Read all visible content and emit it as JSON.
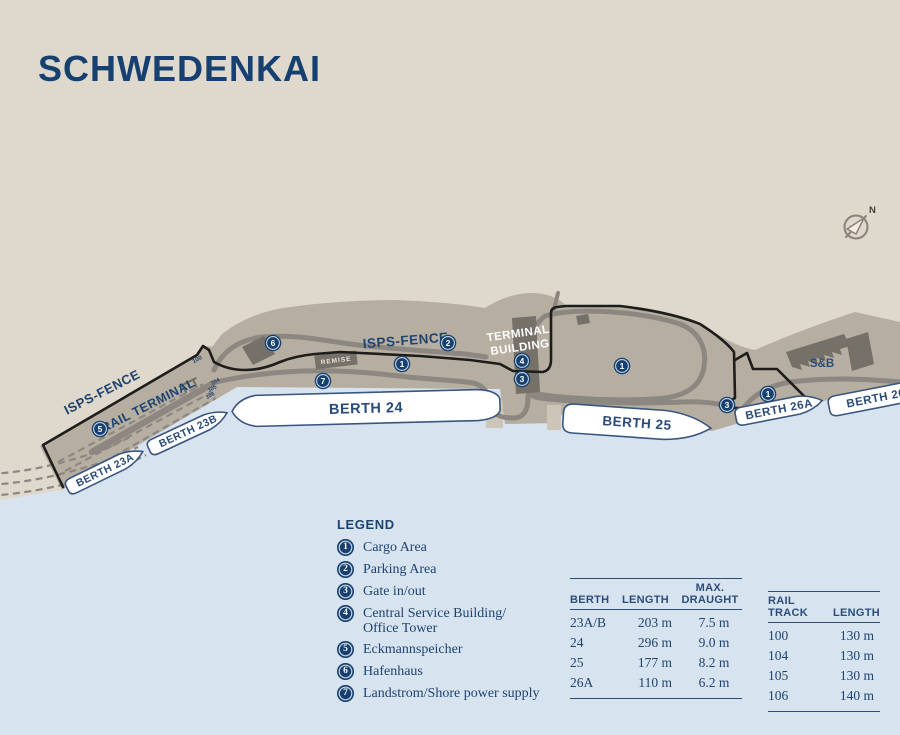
{
  "title": "SCHWEDENKAI",
  "compass": {
    "north_label": "N"
  },
  "colors": {
    "navy": "#16406f",
    "beige": "#dfd8cc",
    "water": "#d7e3ef",
    "pier": "#b7aea2",
    "road": "#8d8781",
    "building": "#757068",
    "fence": "#1d1d1b",
    "ship_fill": "#ffffff"
  },
  "map": {
    "labels": {
      "isps_fence_left": "ISPS-FENCE",
      "isps_fence_center": "ISPS-FENCE",
      "rail_terminal": "RAIL TERMINAL",
      "terminal_building_line1": "TERMINAL",
      "terminal_building_line2": "BUILDING",
      "remise": "REMISE",
      "sb_company": "S&B",
      "track_100": "100",
      "track_104": "104",
      "track_105": "105",
      "track_106": "106"
    },
    "ships": [
      {
        "label": "BERTH 23A"
      },
      {
        "label": "BERTH 23B"
      },
      {
        "label": "BERTH 24"
      },
      {
        "label": "BERTH 25"
      },
      {
        "label": "BERTH 26A"
      },
      {
        "label": "BERTH 26B"
      }
    ],
    "markers": [
      {
        "number": "6"
      },
      {
        "number": "2"
      },
      {
        "number": "1"
      },
      {
        "number": "7"
      },
      {
        "number": "4"
      },
      {
        "number": "3"
      },
      {
        "number": "5"
      },
      {
        "number": "1"
      },
      {
        "number": "3"
      },
      {
        "number": "1"
      }
    ]
  },
  "legend": {
    "heading": "LEGEND",
    "items": [
      {
        "number": "1",
        "label": "Cargo Area",
        "label_line2": ""
      },
      {
        "number": "2",
        "label": "Parking Area",
        "label_line2": ""
      },
      {
        "number": "3",
        "label": "Gate in/out",
        "label_line2": ""
      },
      {
        "number": "4",
        "label": "Central Service Building/",
        "label_line2": "Office Tower"
      },
      {
        "number": "5",
        "label": "Eckmannspeicher",
        "label_line2": ""
      },
      {
        "number": "6",
        "label": "Hafenhaus",
        "label_line2": ""
      },
      {
        "number": "7",
        "label": "Landstrom/Shore power supply",
        "label_line2": ""
      }
    ]
  },
  "berth_table": {
    "header_berth": "BERTH",
    "header_length": "LENGTH",
    "header_draught_line1": "MAX.",
    "header_draught_line2": "DRAUGHT",
    "rows": [
      {
        "berth": "23A/B",
        "length": "203 m",
        "draught": "7.5 m"
      },
      {
        "berth": "24",
        "length": "296 m",
        "draught": "9.0 m"
      },
      {
        "berth": "25",
        "length": "177 m",
        "draught": "8.2 m"
      },
      {
        "berth": "26A",
        "length": "110 m",
        "draught": "6.2 m"
      }
    ]
  },
  "rail_table": {
    "header_track_line1": "RAIL",
    "header_track_line2": "TRACK",
    "header_length": "LENGTH",
    "rows": [
      {
        "track": "100",
        "length": "130 m"
      },
      {
        "track": "104",
        "length": "130 m"
      },
      {
        "track": "105",
        "length": "130 m"
      },
      {
        "track": "106",
        "length": "140 m"
      }
    ]
  }
}
